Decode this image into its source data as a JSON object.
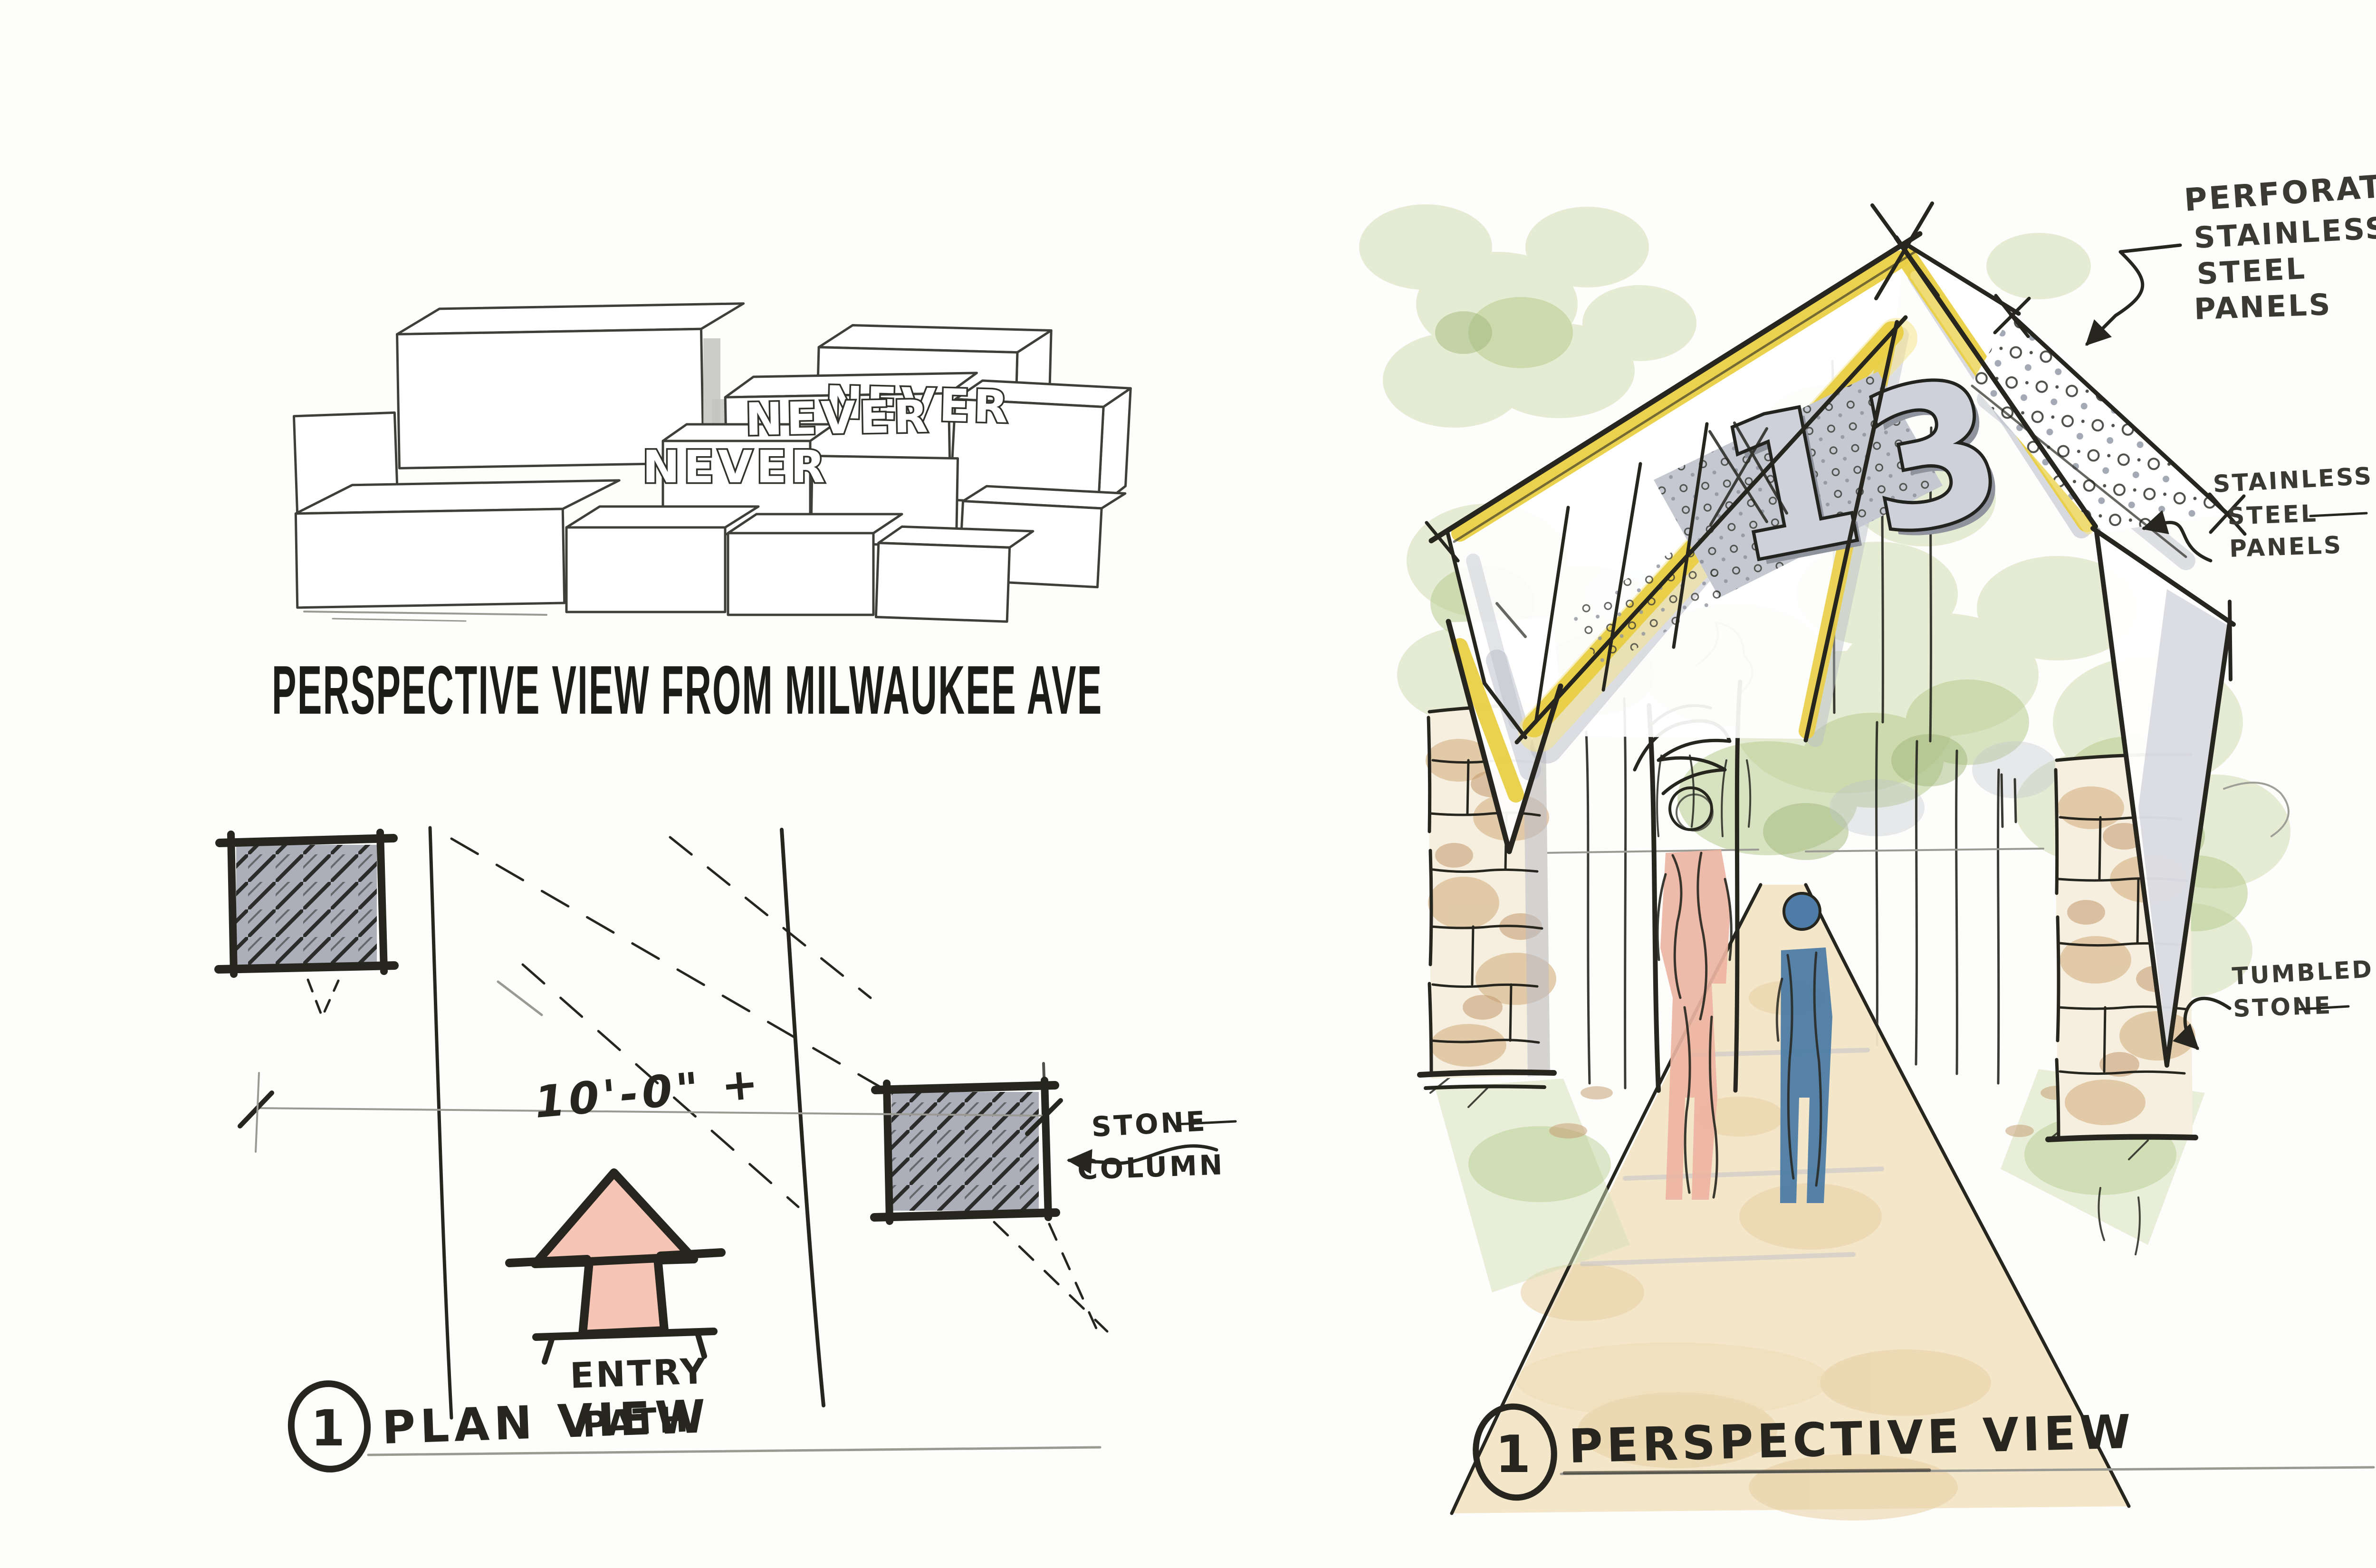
{
  "colors": {
    "paper": "#fdfdfb",
    "ink": "#26261f",
    "pencil": "#9a9a92",
    "yellow": "#e9cf45",
    "yellowLight": "#f6e68f",
    "panelGray": "#c5c8d0",
    "shadowGray": "#b9bcc7",
    "foliageLight": "#d4e0b5",
    "foliageMid": "#b4ca8c",
    "foliageDark": "#9cb573",
    "pathTan": "#f3e5c6",
    "pathSpot": "#e7cfa2",
    "stoneTan": "#ddc19b",
    "stoneDark": "#c3996b",
    "figurePink": "#edb4a2",
    "figureBlue": "#4d7ca6",
    "planColumn": "#9ea1ae",
    "arrowPink": "#f6c5b5"
  },
  "left_sketch": {
    "block_label": "NEVER",
    "caption": "PERSPECTIVE VIEW FROM MILWAUKEE AVE"
  },
  "plan_view": {
    "dimension_label": "10'-0\" +",
    "column_note": [
      "STONE",
      "COLUMN"
    ],
    "entry_label": [
      "ENTRY",
      "PATH"
    ],
    "marker_number": "1",
    "title": "PLAN VIEW"
  },
  "perspective_view": {
    "sign_text": "13",
    "perforated_note": [
      "PERFORATED",
      "STAINLESS",
      "STEEL",
      "PANELS"
    ],
    "stainless_note": [
      "STAINLESS",
      "STEEL",
      "PANELS"
    ],
    "stone_note": [
      "TUMBLED",
      "STONE"
    ],
    "marker_number": "1",
    "title": "PERSPECTIVE VIEW"
  }
}
